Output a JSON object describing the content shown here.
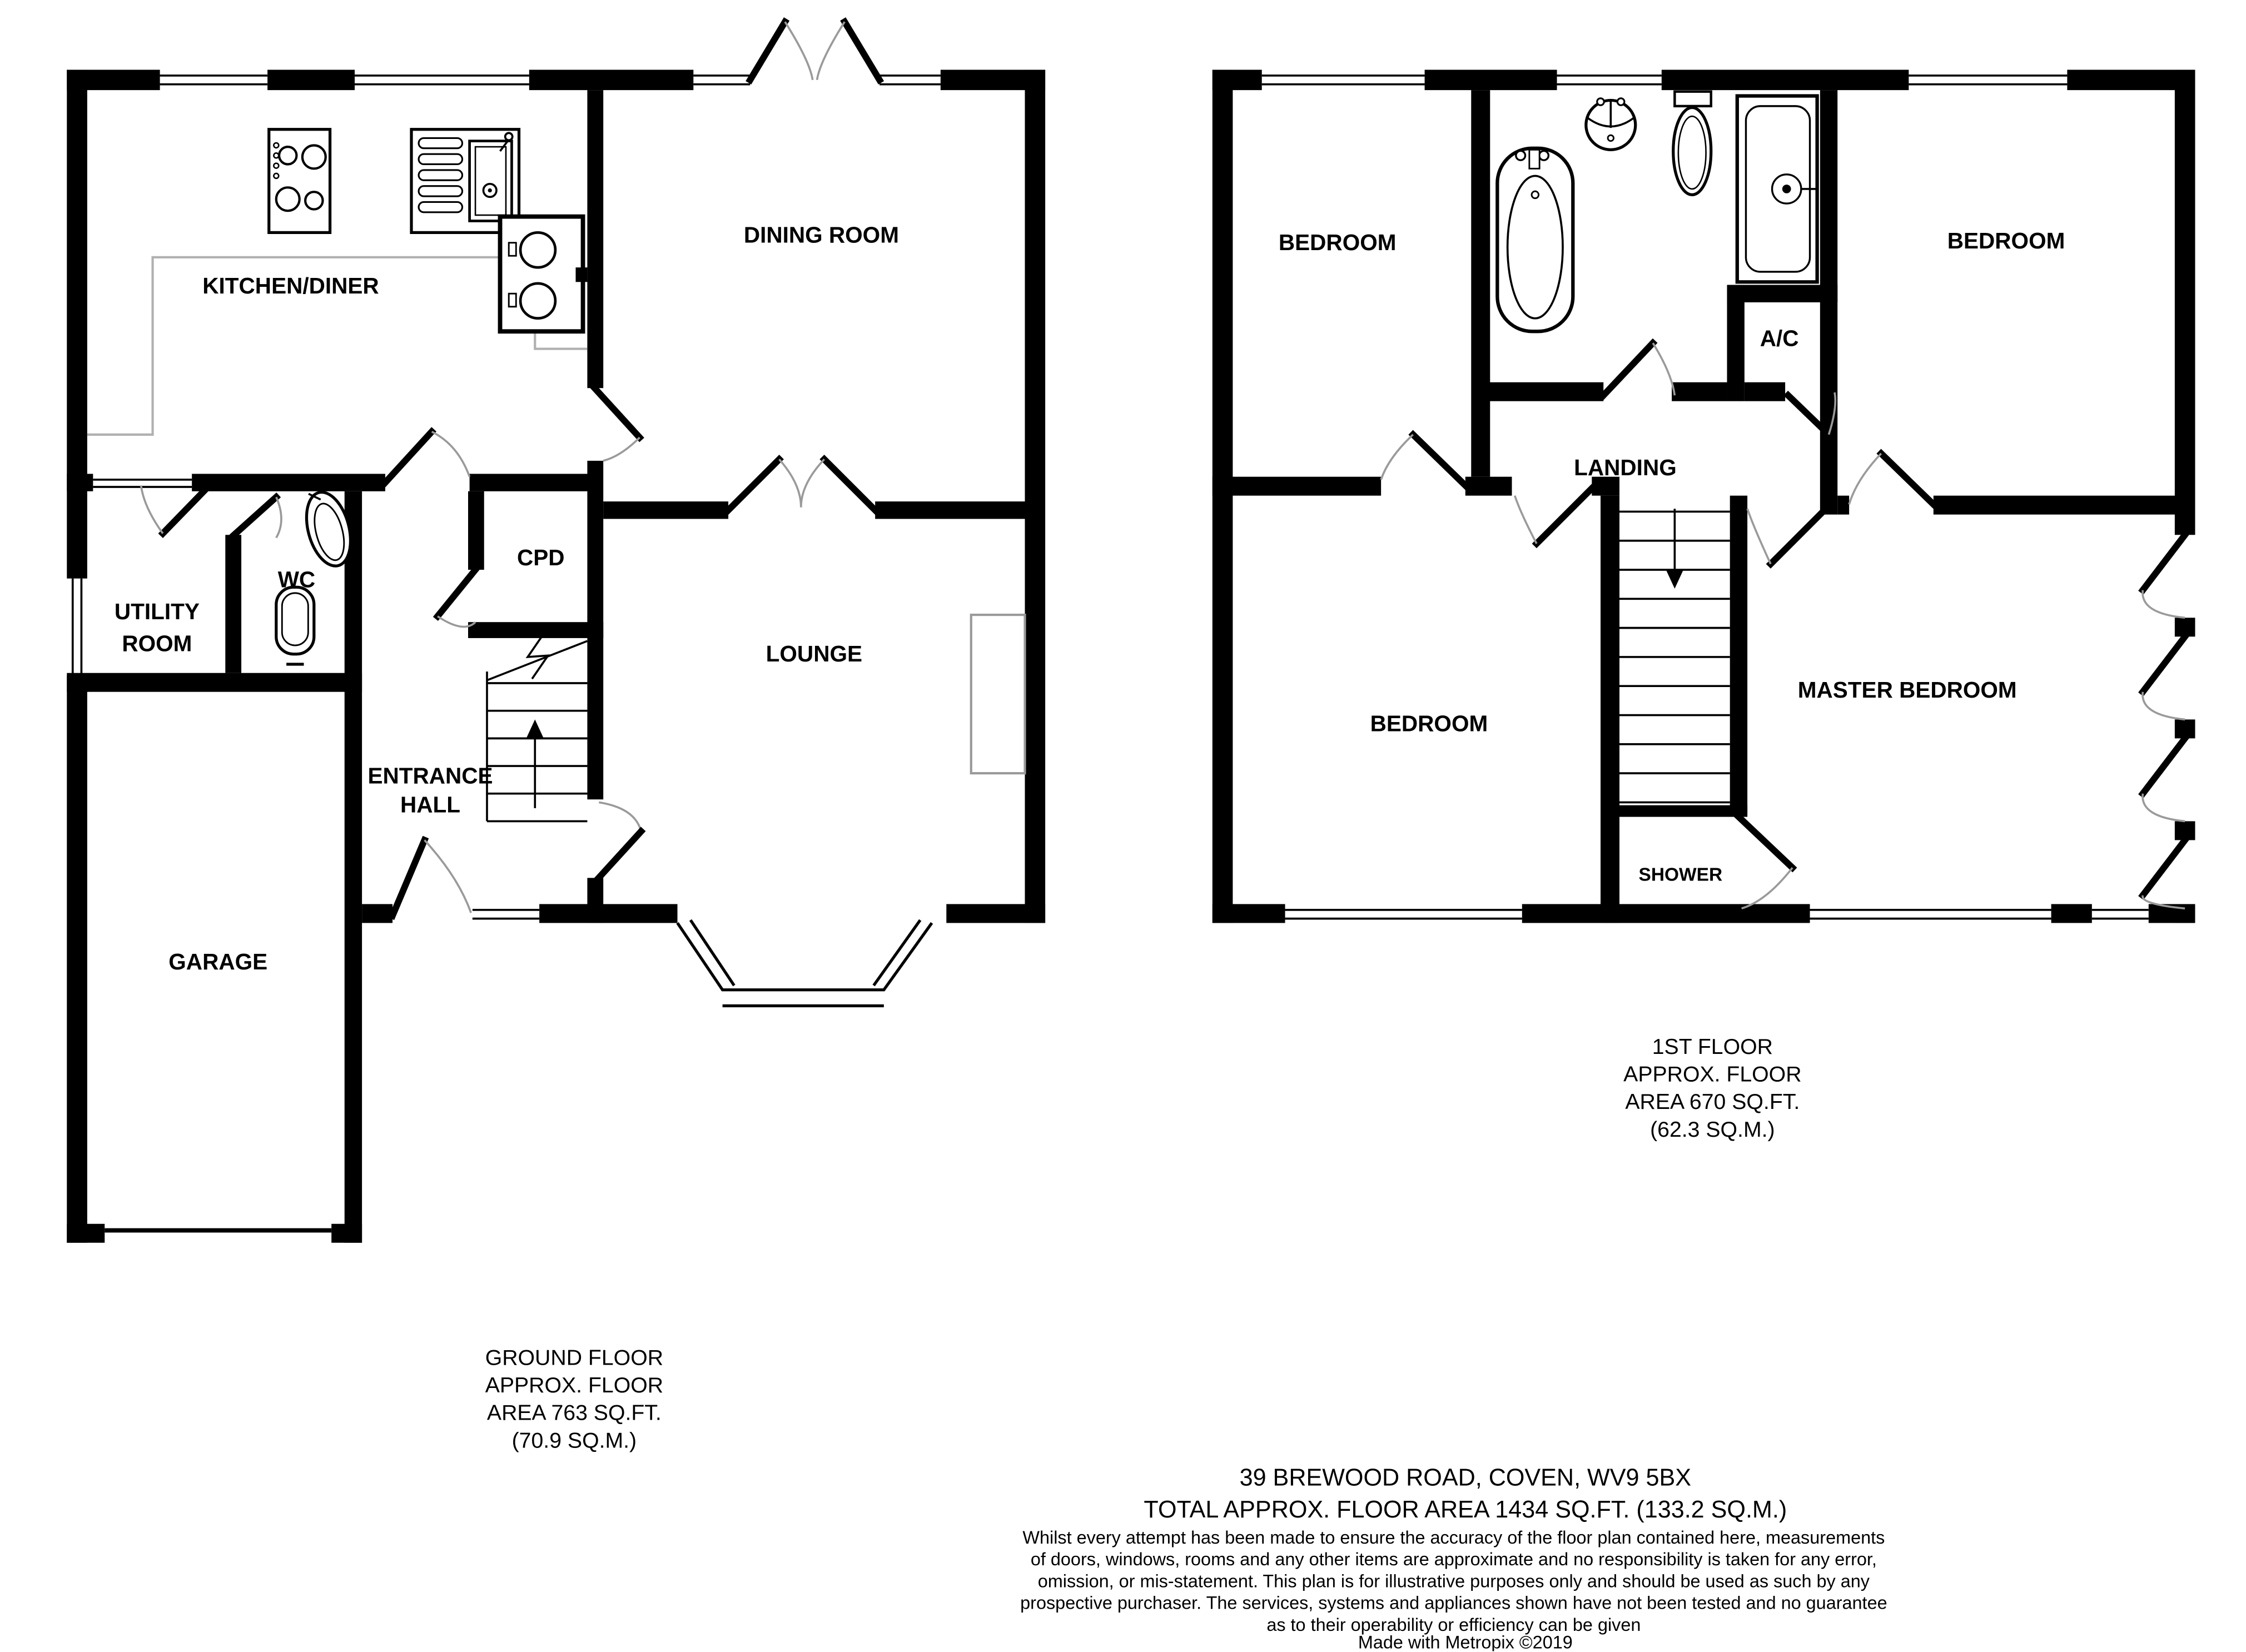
{
  "floorplan": {
    "ground_floor": {
      "rooms": {
        "kitchen": "KITCHEN/DINER",
        "dining": "DINING ROOM",
        "cpd": "CPD",
        "wc": "WC",
        "utility_line1": "UTILITY",
        "utility_line2": "ROOM",
        "lounge": "LOUNGE",
        "hall_line1": "ENTRANCE",
        "hall_line2": "HALL",
        "garage": "GARAGE"
      },
      "caption": [
        "GROUND FLOOR",
        "APPROX. FLOOR",
        "AREA 763 SQ.FT.",
        "(70.9 SQ.M.)"
      ]
    },
    "first_floor": {
      "rooms": {
        "bedroom_top_left": "BEDROOM",
        "bedroom_top_right": "BEDROOM",
        "ac": "A/C",
        "landing": "LANDING",
        "bedroom_bottom_left": "BEDROOM",
        "master": "MASTER BEDROOM",
        "shower": "SHOWER"
      },
      "caption": [
        "1ST FLOOR",
        "APPROX. FLOOR",
        "AREA 670 SQ.FT.",
        "(62.3 SQ.M.)"
      ]
    },
    "footer": {
      "address": "39 BREWOOD ROAD, COVEN, WV9 5BX",
      "total": "TOTAL APPROX. FLOOR AREA 1434 SQ.FT. (133.2 SQ.M.)",
      "disclaimer": [
        "Whilst every attempt has been made to ensure the accuracy of the floor plan contained here, measurements",
        "of doors, windows, rooms and any other items are approximate and no responsibility is taken for any error,",
        "omission, or mis-statement. This plan is for illustrative purposes only and should be used as such by any",
        "prospective purchaser. The services, systems and appliances shown have not been tested and no guarantee",
        "as to their operability or efficiency can be given"
      ],
      "credit": "Made with Metropix ©2019"
    },
    "icons": [
      "hob-icon",
      "sink-icon",
      "appliance-icon",
      "basin-icon",
      "toilet-icon",
      "bath-icon",
      "shower-tray-icon",
      "stairs-up-icon",
      "stairs-down-icon",
      "bay-window",
      "garage-door",
      "fireplace",
      "casement-windows"
    ],
    "colors": {
      "wall": "#000000",
      "door_arc": "#9a9a9a",
      "worktop": "#b0b0b0"
    }
  }
}
